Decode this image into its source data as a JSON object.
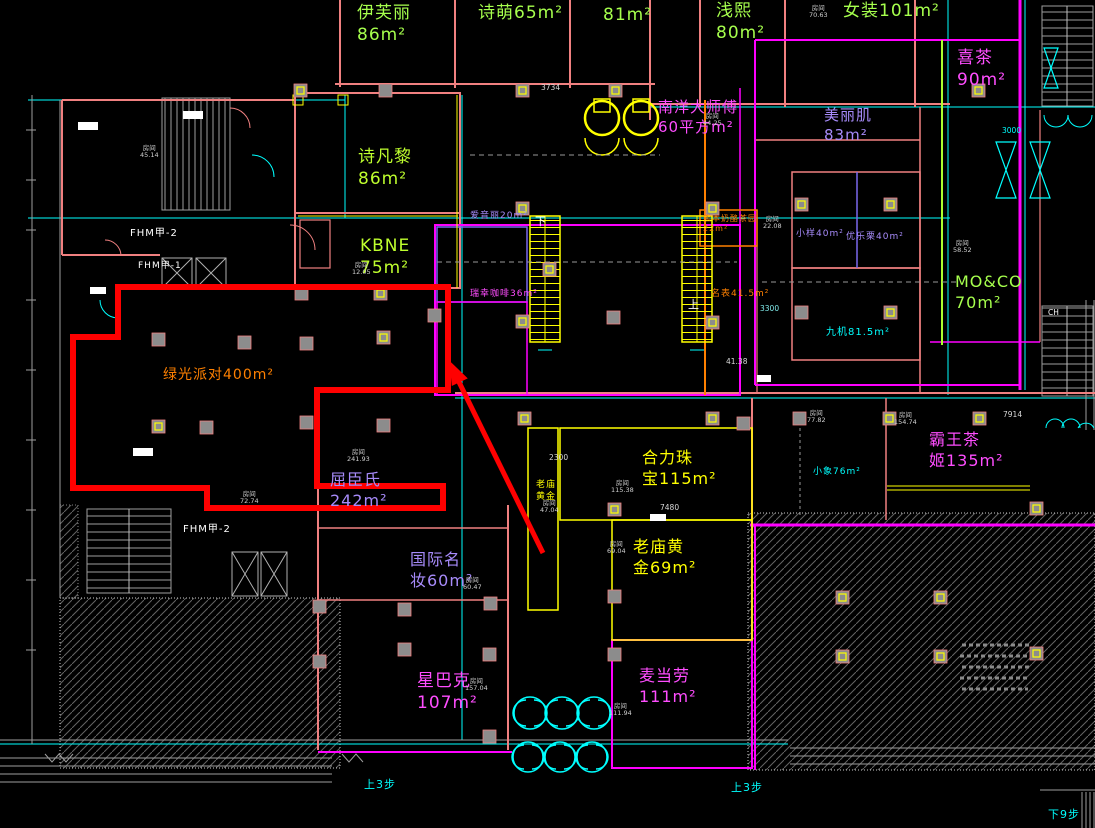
{
  "canvas": {
    "width": 1095,
    "height": 828,
    "background": "#000000"
  },
  "highlight": {
    "store": "绿光派对",
    "area": "400m²",
    "outline_color": "#FF0000",
    "arrow_color": "#FF0000"
  },
  "labels": [
    {
      "name": "store-label-yifuli",
      "text": "伊芙丽\n86m²",
      "x": 357,
      "y": 2,
      "size": 17,
      "color": "#A6FF4D"
    },
    {
      "name": "store-label-shimeng",
      "text": "诗萌65m²",
      "x": 478,
      "y": 2,
      "size": 17,
      "color": "#A6FF4D"
    },
    {
      "name": "store-label-81",
      "text": "81m²",
      "x": 603,
      "y": 4,
      "size": 17,
      "color": "#A6FF4D"
    },
    {
      "name": "store-label-qianxi",
      "text": "浅熙\n80m²",
      "x": 716,
      "y": 0,
      "size": 17,
      "color": "#A6FF4D"
    },
    {
      "name": "store-label-nvzhuang",
      "text": "女装101m²",
      "x": 843,
      "y": 0,
      "size": 17,
      "color": "#A6FF4D"
    },
    {
      "name": "store-label-xicha",
      "text": "喜茶\n90m²",
      "x": 957,
      "y": 47,
      "size": 17,
      "color": "#FF4DFF"
    },
    {
      "name": "store-label-shifanli",
      "text": "诗凡黎\n86m²",
      "x": 358,
      "y": 146,
      "size": 17,
      "color": "#BFFF2E"
    },
    {
      "name": "store-label-kbne",
      "text": "KBNE\n75m²",
      "x": 360,
      "y": 235,
      "size": 17,
      "color": "#BFFF2E"
    },
    {
      "name": "store-label-nanyangdashifu",
      "text": "南洋大师傅\n60平方m²",
      "x": 658,
      "y": 98,
      "size": 15,
      "color": "#FF4DFF"
    },
    {
      "name": "store-label-meiliji",
      "text": "美丽肌\n83m²",
      "x": 824,
      "y": 106,
      "size": 15,
      "color": "#A78BFA"
    },
    {
      "name": "store-label-aiyinli",
      "text": "爱音丽20m²",
      "x": 470,
      "y": 211,
      "size": 9,
      "color": "#A78BFA"
    },
    {
      "name": "store-label-ruixingkafei",
      "text": "瑞幸咖啡36m²",
      "x": 470,
      "y": 289,
      "size": 9,
      "color": "#FF4DFF"
    },
    {
      "name": "store-label-xiongben",
      "text": "熊本奶酪茶园\n22m²",
      "x": 703,
      "y": 214,
      "size": 8,
      "color": "#FF8000"
    },
    {
      "name": "store-label-mingbiao",
      "text": "名表41.5m²",
      "x": 711,
      "y": 289,
      "size": 9,
      "color": "#FF8000"
    },
    {
      "name": "store-label-xiaoyang",
      "text": "小样40m²",
      "x": 796,
      "y": 229,
      "size": 9,
      "color": "#A78BFA"
    },
    {
      "name": "store-label-youleli",
      "text": "优乐栗40m²",
      "x": 846,
      "y": 232,
      "size": 9,
      "color": "#A78BFA"
    },
    {
      "name": "store-label-jiuji",
      "text": "九机81.5m²",
      "x": 826,
      "y": 326,
      "size": 10,
      "color": "#00FFFF"
    },
    {
      "name": "store-label-moco",
      "text": "MO&CO\n70m²",
      "x": 955,
      "y": 272,
      "size": 16,
      "color": "#A6FF4D"
    },
    {
      "name": "store-label-lvguangpaidui",
      "text": "绿光派对400m²",
      "x": 163,
      "y": 366,
      "size": 14,
      "color": "#FF8000"
    },
    {
      "name": "store-label-quchenshi",
      "text": "屈臣氏\n242m²",
      "x": 330,
      "y": 470,
      "size": 16,
      "color": "#A78BFA"
    },
    {
      "name": "store-label-helizhubao",
      "text": "合力珠\n宝115m²",
      "x": 642,
      "y": 448,
      "size": 16,
      "color": "#FFFF00"
    },
    {
      "name": "store-label-laomiaohuangjin",
      "text": "老庙黄\n金69m²",
      "x": 633,
      "y": 537,
      "size": 16,
      "color": "#FFFF00"
    },
    {
      "name": "store-label-laomiao-corridor",
      "text": "老庙\n黄金",
      "x": 536,
      "y": 480,
      "size": 9,
      "color": "#FFFF00"
    },
    {
      "name": "store-label-guojimingzhuang",
      "text": "国际名\n妆60m²",
      "x": 410,
      "y": 550,
      "size": 16,
      "color": "#A78BFA"
    },
    {
      "name": "store-label-xingbake",
      "text": "星巴克\n107m²",
      "x": 417,
      "y": 670,
      "size": 17,
      "color": "#FF4DFF"
    },
    {
      "name": "store-label-maidanglao",
      "text": "麦当劳\n111m²",
      "x": 639,
      "y": 666,
      "size": 16,
      "color": "#FF4DFF"
    },
    {
      "name": "store-label-bawangchaji",
      "text": "霸王茶\n姬135m²",
      "x": 929,
      "y": 430,
      "size": 16,
      "color": "#FF4DFF"
    },
    {
      "name": "store-label-xiaoxiang",
      "text": "小象76m²",
      "x": 813,
      "y": 467,
      "size": 9,
      "color": "#00FFFF"
    },
    {
      "name": "fire-door-label-1",
      "text": "FHM甲-2",
      "x": 130,
      "y": 227,
      "size": 10,
      "color": "#FFFFFF"
    },
    {
      "name": "fire-door-label-2",
      "text": "FHM甲-1",
      "x": 138,
      "y": 261,
      "size": 9,
      "color": "#FFFFFF"
    },
    {
      "name": "fire-door-label-3",
      "text": "FHM甲-2",
      "x": 183,
      "y": 523,
      "size": 10,
      "color": "#FFFFFF"
    },
    {
      "name": "escalator-down-label",
      "text": "下",
      "x": 535,
      "y": 215,
      "size": 11,
      "color": "#FFFFFF"
    },
    {
      "name": "escalator-up-label",
      "text": "上",
      "x": 688,
      "y": 298,
      "size": 11,
      "color": "#FFFFFF"
    },
    {
      "name": "step-label-1",
      "text": "上3步",
      "x": 364,
      "y": 778,
      "size": 11,
      "color": "#00FFFF"
    },
    {
      "name": "step-label-2",
      "text": "上3步",
      "x": 731,
      "y": 781,
      "size": 11,
      "color": "#00FFFF"
    },
    {
      "name": "step-label-3",
      "text": "下9步",
      "x": 1048,
      "y": 808,
      "size": 11,
      "color": "#00FFFF"
    }
  ],
  "room_tags": [
    {
      "label": "房间",
      "value": "45.14",
      "x": 140,
      "y": 145
    },
    {
      "label": "房间",
      "value": "12.05",
      "x": 352,
      "y": 262
    },
    {
      "label": "房间",
      "value": "241.93",
      "x": 347,
      "y": 449
    },
    {
      "label": "房间",
      "value": "72.74",
      "x": 240,
      "y": 491
    },
    {
      "label": "房间",
      "value": "115.38",
      "x": 611,
      "y": 480
    },
    {
      "label": "房间",
      "value": "69.04",
      "x": 607,
      "y": 541
    },
    {
      "label": "房间",
      "value": "60.47",
      "x": 463,
      "y": 577
    },
    {
      "label": "房间",
      "value": "157.04",
      "x": 465,
      "y": 678
    },
    {
      "label": "房间",
      "value": "111.94",
      "x": 609,
      "y": 703
    },
    {
      "label": "房间",
      "value": "77.82",
      "x": 807,
      "y": 410
    },
    {
      "label": "房间",
      "value": "154.74",
      "x": 894,
      "y": 412
    },
    {
      "label": "房间",
      "value": "70.63",
      "x": 809,
      "y": 5
    },
    {
      "label": "房间",
      "value": "58.52",
      "x": 953,
      "y": 240
    },
    {
      "label": "房间",
      "value": "22.08",
      "x": 763,
      "y": 216
    },
    {
      "label": "房间",
      "value": "44.25",
      "x": 703,
      "y": 113
    },
    {
      "label": "房间",
      "value": "47.04",
      "x": 540,
      "y": 500
    }
  ],
  "dimensions": [
    {
      "text": "3734",
      "x": 541,
      "y": 83,
      "color": "#d8d8d8"
    },
    {
      "text": "2300",
      "x": 549,
      "y": 453,
      "color": "#d8d8d8"
    },
    {
      "text": "7480",
      "x": 660,
      "y": 503,
      "color": "#d8d8d8"
    },
    {
      "text": "7914",
      "x": 1003,
      "y": 410,
      "color": "#d8d8d8"
    },
    {
      "text": "CH",
      "x": 1048,
      "y": 308,
      "color": "#ffffff"
    },
    {
      "text": "3300",
      "x": 760,
      "y": 304,
      "color": "#7fe8e8"
    },
    {
      "text": "3000",
      "x": 1002,
      "y": 126,
      "color": "#00FFFF"
    },
    {
      "text": "41.38",
      "x": 726,
      "y": 357,
      "color": "#d8d8d8"
    }
  ]
}
